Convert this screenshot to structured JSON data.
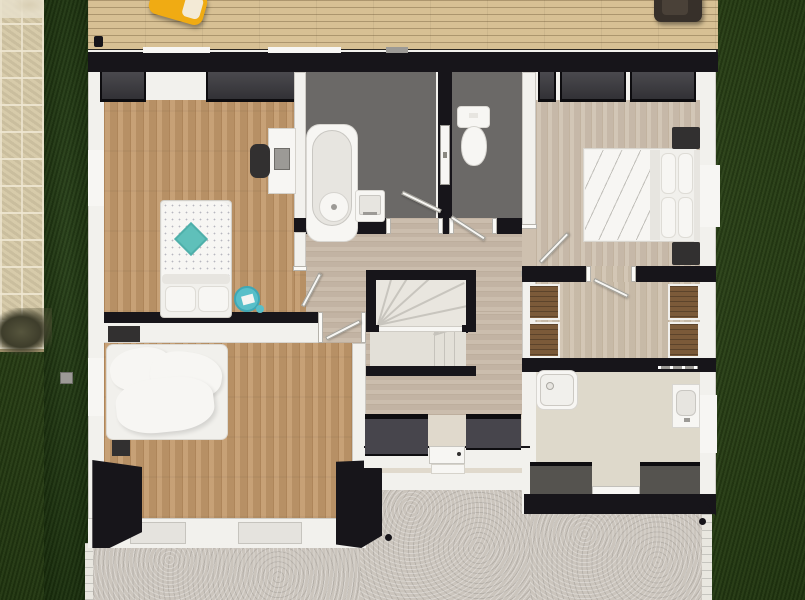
{
  "meta": {
    "description": "Top-down 3D architectural render of a residential floor plan with deck, stone path, lawn and concrete patio",
    "view": "overhead 3D dollhouse render",
    "visible_text": "none"
  },
  "palette": {
    "grass": "#2a4514",
    "grassDark": "#1e380e",
    "stone": "#d5c8a6",
    "stoneLight": "#e8e0cb",
    "concrete": "#cbc5bd",
    "paver": "#e9e7e0",
    "deckWood": "#d7c094",
    "wallBlack": "#17151a",
    "wallWhite": "#f2f1ed",
    "grayWall": "#5f5e5c",
    "grayBlock": "#55534f",
    "oakFloor": "#c2996b",
    "masterFloor": "#cec0af",
    "hallFloor": "#c8b9a8",
    "closetFloor": "#cfc1ae",
    "bathFloor": "#6b6967",
    "bath2Floor": "#ded9cb",
    "entryFloor": "#e0d9cc",
    "stairTread": "#e9e6df",
    "stairTreadLow": "#e3e0d8",
    "darkCloset": "#3b3a3f",
    "entryCloset": "#47454c",
    "wardrobeWood": "#7b5a39",
    "white": "#f7f6f3",
    "bedWhite": "#f1f0ec",
    "duvetFold": "#e7e5e0",
    "windowLight": "#e5e3de",
    "teal": "#5fc0ba",
    "tealTable": "#58bfc9",
    "chairYellow": "#f0ab13",
    "chairBrown": "#37302a",
    "darkFurniture": "#323030",
    "metal": "#9c9a96"
  },
  "outdoor": {
    "lawn": "dark green grass on left strip, right side and bottom-left corner",
    "stone_path": {
      "position": "far left",
      "features": [
        "flagstone tiles",
        "dried shrub",
        "stepping stone"
      ]
    },
    "deck": {
      "position": "top",
      "features": [
        "horizontal wood planks",
        "yellow armchair",
        "dark brown chair",
        "post"
      ]
    },
    "patio": {
      "position": "bottom",
      "features": [
        "speckled concrete",
        "white paver edges",
        "porch step",
        "two outdoor floor lights"
      ]
    }
  },
  "rooms": [
    {
      "id": "bedroom-1",
      "position": "top-left",
      "floor": "warm oak planks",
      "furniture": [
        "single bed with dotted duvet",
        "teal diamond cushion",
        "two white pillows",
        "round teal side table",
        "small teal cup",
        "white desk",
        "dark desk chair",
        "two dark built-in wardrobes on north wall"
      ]
    },
    {
      "id": "bathroom",
      "position": "top-center",
      "floor": "dark gray",
      "fixtures": [
        "bathtub with round faucet-end",
        "square basin sink",
        "door swing to hallway"
      ]
    },
    {
      "id": "wc",
      "position": "top-center-right",
      "floor": "dark gray",
      "fixtures": [
        "toilet with tank",
        "white door in divider wall",
        "door swing to hallway"
      ]
    },
    {
      "id": "master-bedroom",
      "position": "top-right",
      "floor": "whitewashed planks",
      "furniture": [
        "double bed with four pillows",
        "two dark nightstands",
        "three dark built-in wardrobes on north wall",
        "door swing from hallway"
      ]
    },
    {
      "id": "walk-in-closet",
      "position": "right-middle",
      "floor": "light wood",
      "furniture": [
        "four wooden wardrobe units, two per side",
        "door swing from master bedroom"
      ]
    },
    {
      "id": "hallway",
      "position": "center",
      "floor": "taupe planks",
      "features": [
        "U-shaped winder staircase with black surround and white rail",
        "door swings to bedroom 1 and bedroom 2"
      ]
    },
    {
      "id": "bedroom-2",
      "position": "bottom-left",
      "floor": "warm oak planks",
      "furniture": [
        "unmade double bed with crumpled white duvet",
        "dark wall shelf",
        "dark nightstand",
        "dark corner closet volumes"
      ],
      "windows": [
        "two on south wall"
      ]
    },
    {
      "id": "entry",
      "position": "bottom-center",
      "floor": "light beige",
      "features": [
        "front door with handle",
        "porch step",
        "two dark built-in cabinets"
      ]
    },
    {
      "id": "bathroom-2",
      "position": "bottom-right",
      "floor": "light beige",
      "fixtures": [
        "square shower tray with drain",
        "vanity with basin and tap",
        "towel rail",
        "rear passage to patio"
      ]
    }
  ]
}
